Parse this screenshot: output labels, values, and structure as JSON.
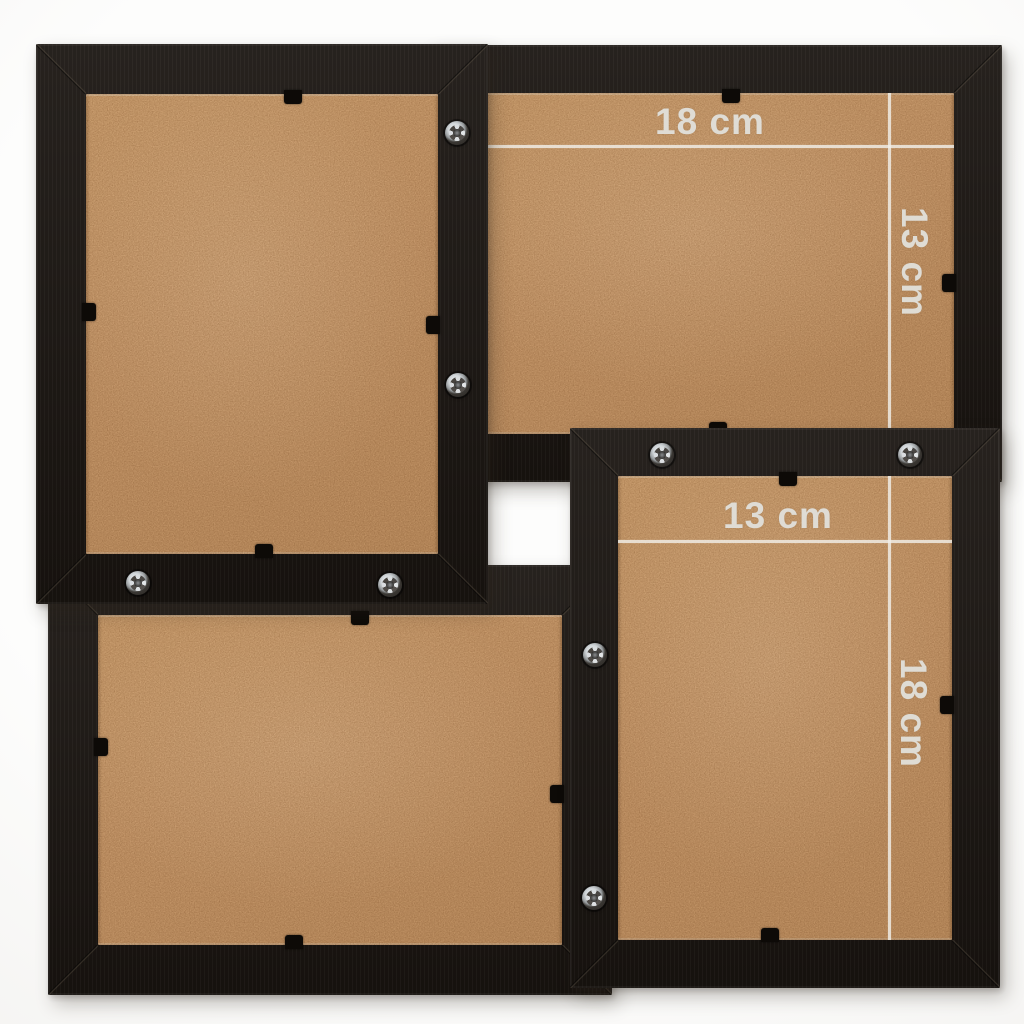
{
  "scene": {
    "description": "Rear view of a black 4-photo collage picture frame; four sections with MDF backing boards, metal screws joining the sections and black retainer clips",
    "frames": [
      {
        "id": "top-left",
        "orientation": "portrait",
        "width_label": "",
        "height_label": ""
      },
      {
        "id": "top-right",
        "orientation": "landscape",
        "width_label": "18 cm",
        "height_label": "13 cm"
      },
      {
        "id": "bottom-left",
        "orientation": "landscape",
        "width_label": "",
        "height_label": ""
      },
      {
        "id": "bottom-right",
        "orientation": "portrait",
        "width_label": "13 cm",
        "height_label": "18 cm"
      }
    ],
    "unit": "cm"
  },
  "colors": {
    "frame_black": "#191410",
    "backing_tan": "#c5976a",
    "dimension_line": "#f2efe9",
    "dimension_text": "#e2e0db",
    "background": "#fdfdfc",
    "screw_silver": "#cfd4d7",
    "clip_black": "#0d0a07"
  }
}
